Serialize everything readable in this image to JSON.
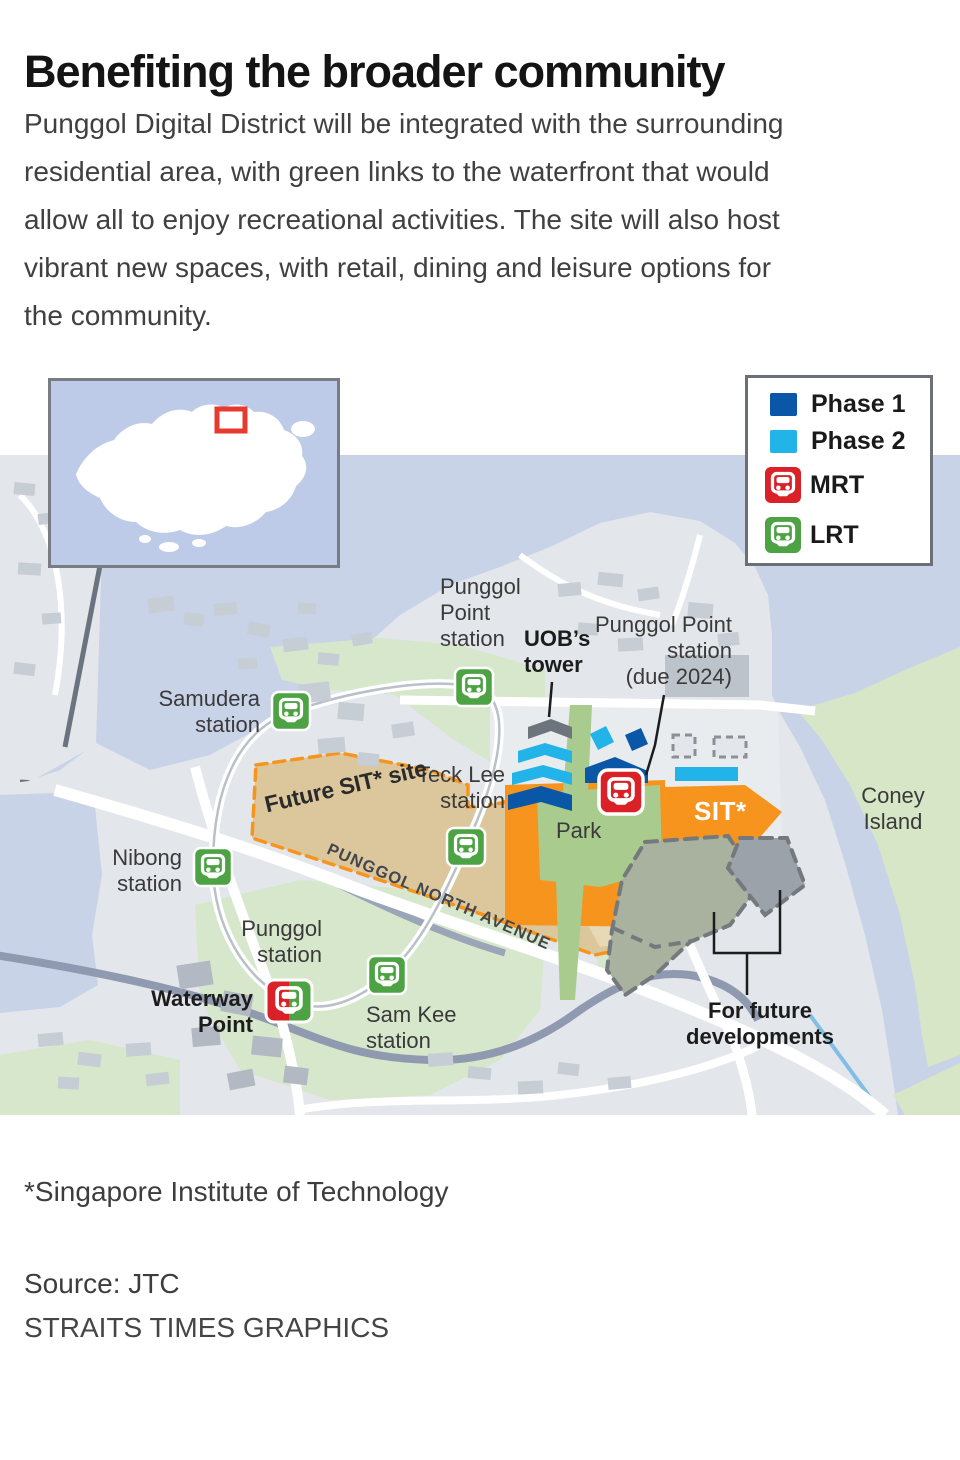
{
  "title": "Benefiting the broader community",
  "intro_lines": [
    "Punggol Digital District will be integrated with the surrounding",
    "residential area, with green links to the waterfront that would",
    "allow all to enjoy recreational activities. The site will also host",
    "vibrant new spaces, with retail, dining and leisure options for",
    "the community."
  ],
  "legend": {
    "phase1": "Phase 1",
    "phase2": "Phase 2",
    "mrt": "MRT",
    "lrt": "LRT"
  },
  "map": {
    "labels": {
      "punggol_point_top": [
        "Punggol",
        "Point",
        "station"
      ],
      "uob_tower": [
        "UOB’s",
        "tower"
      ],
      "punggol_point_2024": [
        "Punggol Point",
        "station",
        "(due 2024)"
      ],
      "samudera": [
        "Samudera",
        "station"
      ],
      "teck_lee": [
        "Teck Lee",
        "station"
      ],
      "future_sit": "Future SIT* site",
      "punggol_north_avenue": "PUNGGOL NORTH AVENUE",
      "nibong": [
        "Nibong",
        "station"
      ],
      "punggol_station": [
        "Punggol",
        "station"
      ],
      "waterway_point": [
        "Waterway",
        "Point"
      ],
      "sam_kee": [
        "Sam Kee",
        "station"
      ],
      "sit": "SIT*",
      "coney_island": [
        "Coney",
        "Island"
      ],
      "future_dev": [
        "For future",
        "developments"
      ],
      "park": "Park"
    }
  },
  "footnote": "*Singapore Institute of Technology",
  "source": "Source: JTC",
  "credit": "STRAITS TIMES GRAPHICS",
  "colors": {
    "phase1_blue": "#0a57a8",
    "phase2_blue": "#22b4e9",
    "mrt_red": "#da2128",
    "lrt_green": "#4da244",
    "sit_orange": "#f7941e",
    "future_sit_tan": "#dcc79c",
    "sea_blue": "#c9d3e8",
    "park_green": "#a9cc8e",
    "island_green": "#d6e6c6",
    "future_dev_sage": "#a9b29f",
    "future_dev_gray": "#9ba2a9"
  }
}
